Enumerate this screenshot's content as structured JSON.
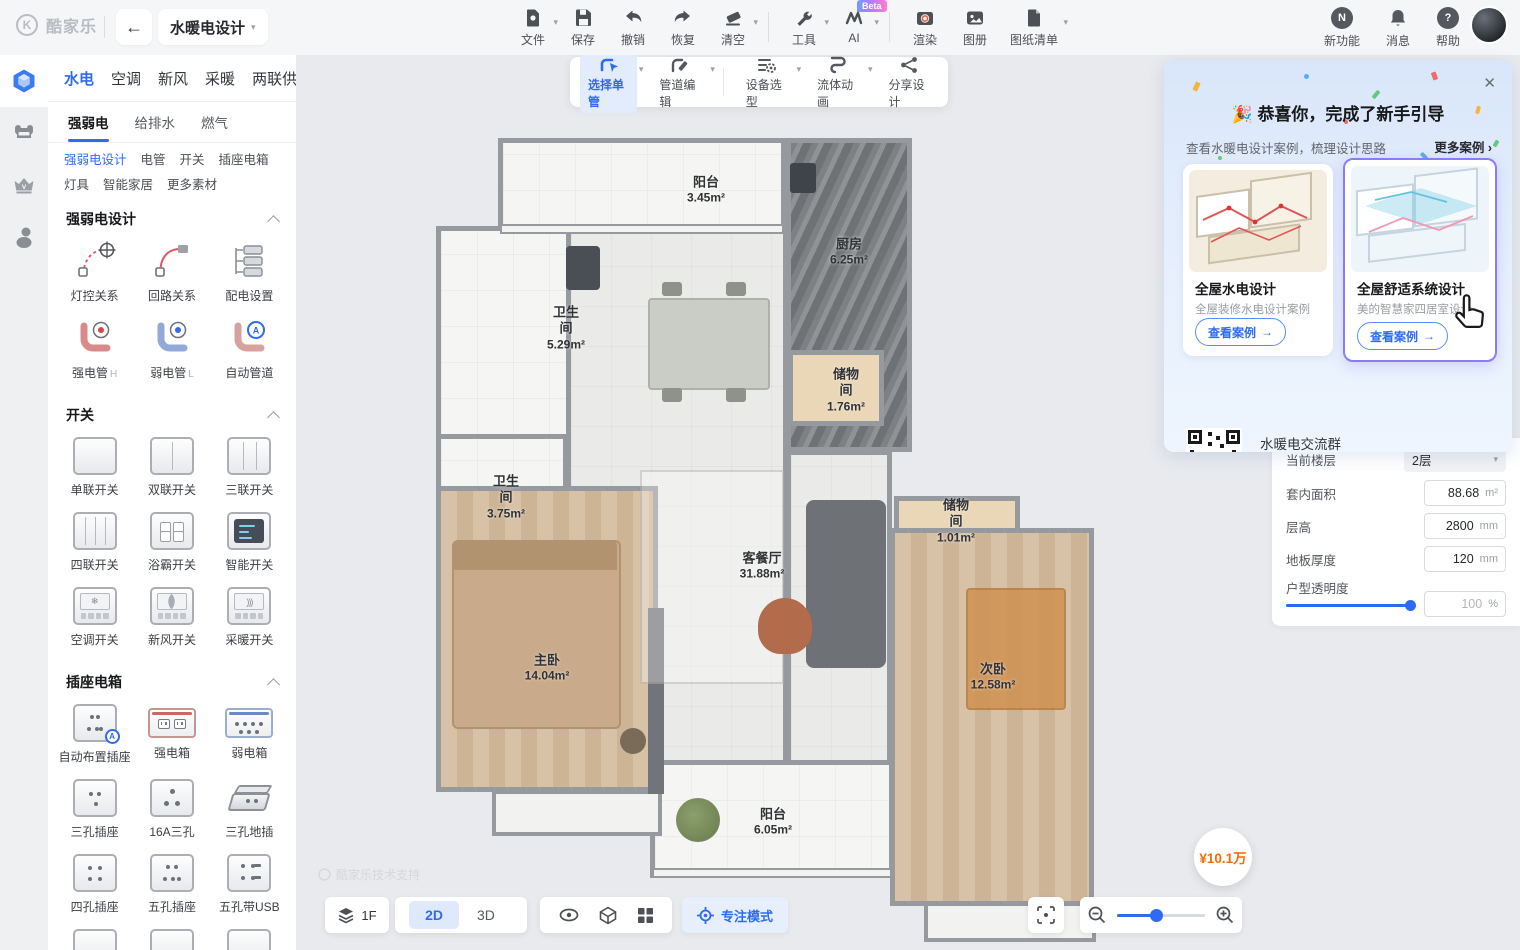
{
  "topbar": {
    "logo": "酷家乐",
    "project": "水暖电设计",
    "items": [
      "文件",
      "保存",
      "撤销",
      "恢复",
      "清空",
      "工具",
      "AI",
      "渲染",
      "图册",
      "图纸清单"
    ],
    "ai_badge": "Beta",
    "right_items": [
      "新功能",
      "消息",
      "帮助"
    ]
  },
  "catalog": {
    "tabs": [
      "水电",
      "空调",
      "新风",
      "采暖",
      "两联供"
    ],
    "subtabs": [
      "强弱电",
      "给排水",
      "燃气"
    ],
    "links": [
      "强弱电设计",
      "电管",
      "开关",
      "插座电箱",
      "灯具",
      "智能家居",
      "更多素材"
    ],
    "pipe_suffix_h": "H",
    "pipe_suffix_l": "L",
    "sections": [
      {
        "title": "强弱电设计",
        "items": [
          "灯控关系",
          "回路关系",
          "配电设置",
          "强电管",
          "弱电管",
          "自动管道"
        ]
      },
      {
        "title": "开关",
        "items": [
          "单联开关",
          "双联开关",
          "三联开关",
          "四联开关",
          "浴霸开关",
          "智能开关",
          "空调开关",
          "新风开关",
          "采暖开关"
        ]
      },
      {
        "title": "插座电箱",
        "items": [
          "自动布置插座",
          "强电箱",
          "弱电箱",
          "三孔插座",
          "16A三孔",
          "三孔地插",
          "四孔插座",
          "五孔插座",
          "五孔带USB"
        ]
      }
    ]
  },
  "canvas_toolbar": [
    "选择单管",
    "管道编辑",
    "设备选型",
    "流体动画",
    "分享设计"
  ],
  "floorplan": {
    "watermark": "酷家乐技术支持",
    "rooms": [
      {
        "name": "阳台",
        "area": "3.45m²"
      },
      {
        "name": "厨房",
        "area": "6.25m²"
      },
      {
        "name": "储物间",
        "area": "1.76m²"
      },
      {
        "name": "卫生间",
        "area": "5.29m²"
      },
      {
        "name": "卫生间",
        "area": "3.75m²"
      },
      {
        "name": "客餐厅",
        "area": "31.88m²"
      },
      {
        "name": "主卧",
        "area": "14.04m²"
      },
      {
        "name": "储物间",
        "area": "1.01m²"
      },
      {
        "name": "次卧",
        "area": "12.58m²"
      },
      {
        "name": "阳台",
        "area": "6.05m²"
      }
    ]
  },
  "onboarding": {
    "title": "恭喜你，完成了新手引导",
    "subtitle": "查看水暖电设计案例，梳理设计思路",
    "more": "更多案例",
    "cards": [
      {
        "title": "全屋水电设计",
        "desc": "全屋装修水电设计案例",
        "button": "查看案例"
      },
      {
        "title": "全屋舒适系统设计",
        "desc": "美的智慧家四居室设计",
        "button": "查看案例"
      }
    ],
    "qr_line1": "水暖电交流群",
    "qr_line2": "进群反馈问题"
  },
  "properties": {
    "floor_label": "当前楼层",
    "floor_value": "2层",
    "area_label": "套内面积",
    "area_value": "88.68",
    "area_unit": "m²",
    "height_label": "层高",
    "height_value": "2800",
    "height_unit": "mm",
    "thickness_label": "地板厚度",
    "thickness_value": "120",
    "thickness_unit": "mm",
    "opacity_label": "户型透明度",
    "opacity_value": "100",
    "opacity_unit": "%"
  },
  "bottom_bar": {
    "floor": "1F",
    "view2d": "2D",
    "view3d": "3D",
    "focus": "专注模式"
  },
  "price_badge": "¥10.1万",
  "colors": {
    "accent": "#2f6bf0",
    "price_orange": "#ff6a00"
  }
}
